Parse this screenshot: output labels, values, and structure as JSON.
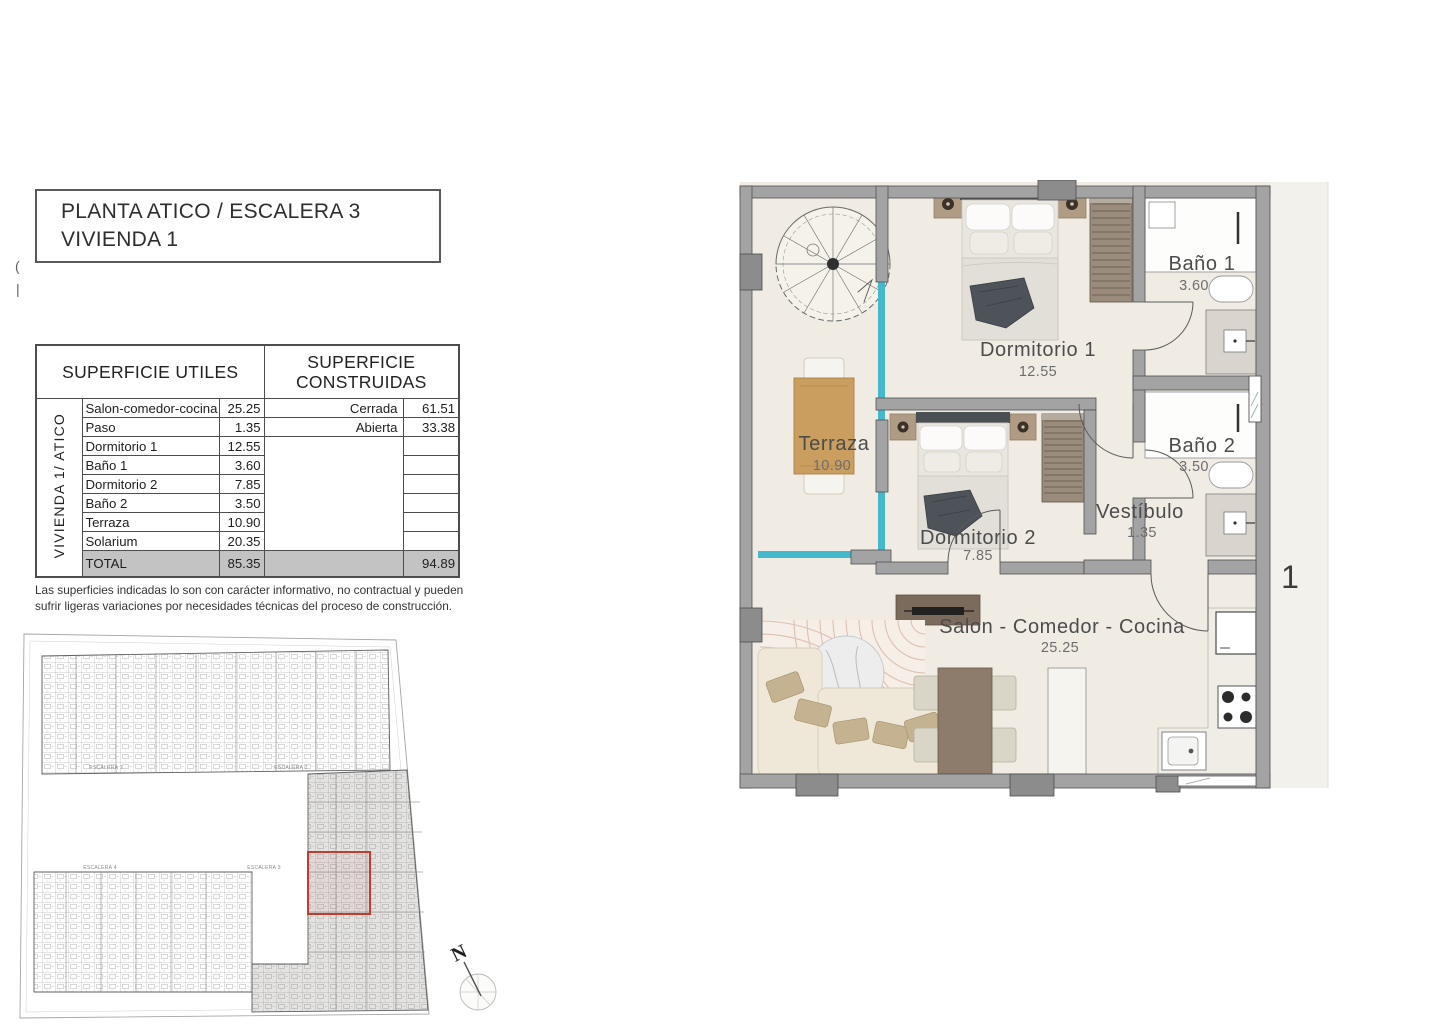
{
  "title_block": {
    "line1": "PLANTA ATICO / ESCALERA 3",
    "line2": "VIVIENDA 1"
  },
  "cropped_text": {
    "glyph1": "(",
    "glyph2": "|"
  },
  "areas_table": {
    "header_left": "SUPERFICIE UTILES",
    "header_right": "SUPERFICIE CONSTRUIDAS",
    "row_group_label": "VIVIENDA 1/ ATICO",
    "rows": [
      {
        "name": "Salon-comedor-cocina",
        "value": "25.25",
        "right_label": "Cerrada",
        "right_value": "61.51"
      },
      {
        "name": "Paso",
        "value": "1.35",
        "right_label": "Abierta",
        "right_value": "33.38"
      },
      {
        "name": "Dormitorio 1",
        "value": "12.55",
        "right_label": "",
        "right_value": ""
      },
      {
        "name": "Baño 1",
        "value": "3.60",
        "right_label": "",
        "right_value": ""
      },
      {
        "name": "Dormitorio 2",
        "value": "7.85",
        "right_label": "",
        "right_value": ""
      },
      {
        "name": "Baño 2",
        "value": "3.50",
        "right_label": "",
        "right_value": ""
      },
      {
        "name": "Terraza",
        "value": "10.90",
        "right_label": "",
        "right_value": ""
      },
      {
        "name": "Solarium",
        "value": "20.35",
        "right_label": "",
        "right_value": ""
      }
    ],
    "total": {
      "label": "TOTAL",
      "value": "85.35",
      "right_value": "94.89"
    }
  },
  "disclaimer": "Las superficies indicadas lo son con carácter informativo, no contractual y pueden sufrir ligeras variaciones por necesidades técnicas del proceso de construcción.",
  "key_plan": {
    "escalera1": "ESCALERA 1",
    "escalera2": "ESCALERA 2",
    "escalera3": "ESCALERA 3",
    "escalera4": "ESCALERA 4",
    "highlight_color": "#c23b2e"
  },
  "north": {
    "label": "N"
  },
  "floor_plan": {
    "unit_number": "1",
    "rooms": [
      {
        "name": "Dormitorio 1",
        "area": "12.55"
      },
      {
        "name": "Baño 1",
        "area": "3.60"
      },
      {
        "name": "Dormitorio 2",
        "area": "7.85"
      },
      {
        "name": "Baño 2",
        "area": "3.50"
      },
      {
        "name": "Vestíbulo",
        "area": "1.35"
      },
      {
        "name": "Terraza",
        "area": "10.90"
      },
      {
        "name": "Salon - Comedor - Cocina",
        "area": "25.25"
      }
    ],
    "colors": {
      "wall": "#a3a3a3",
      "floor": "#f0ece3",
      "glazing": "#45b8cc",
      "wood": "#c99e5f",
      "wardrobe": "#9a8c7d"
    }
  }
}
